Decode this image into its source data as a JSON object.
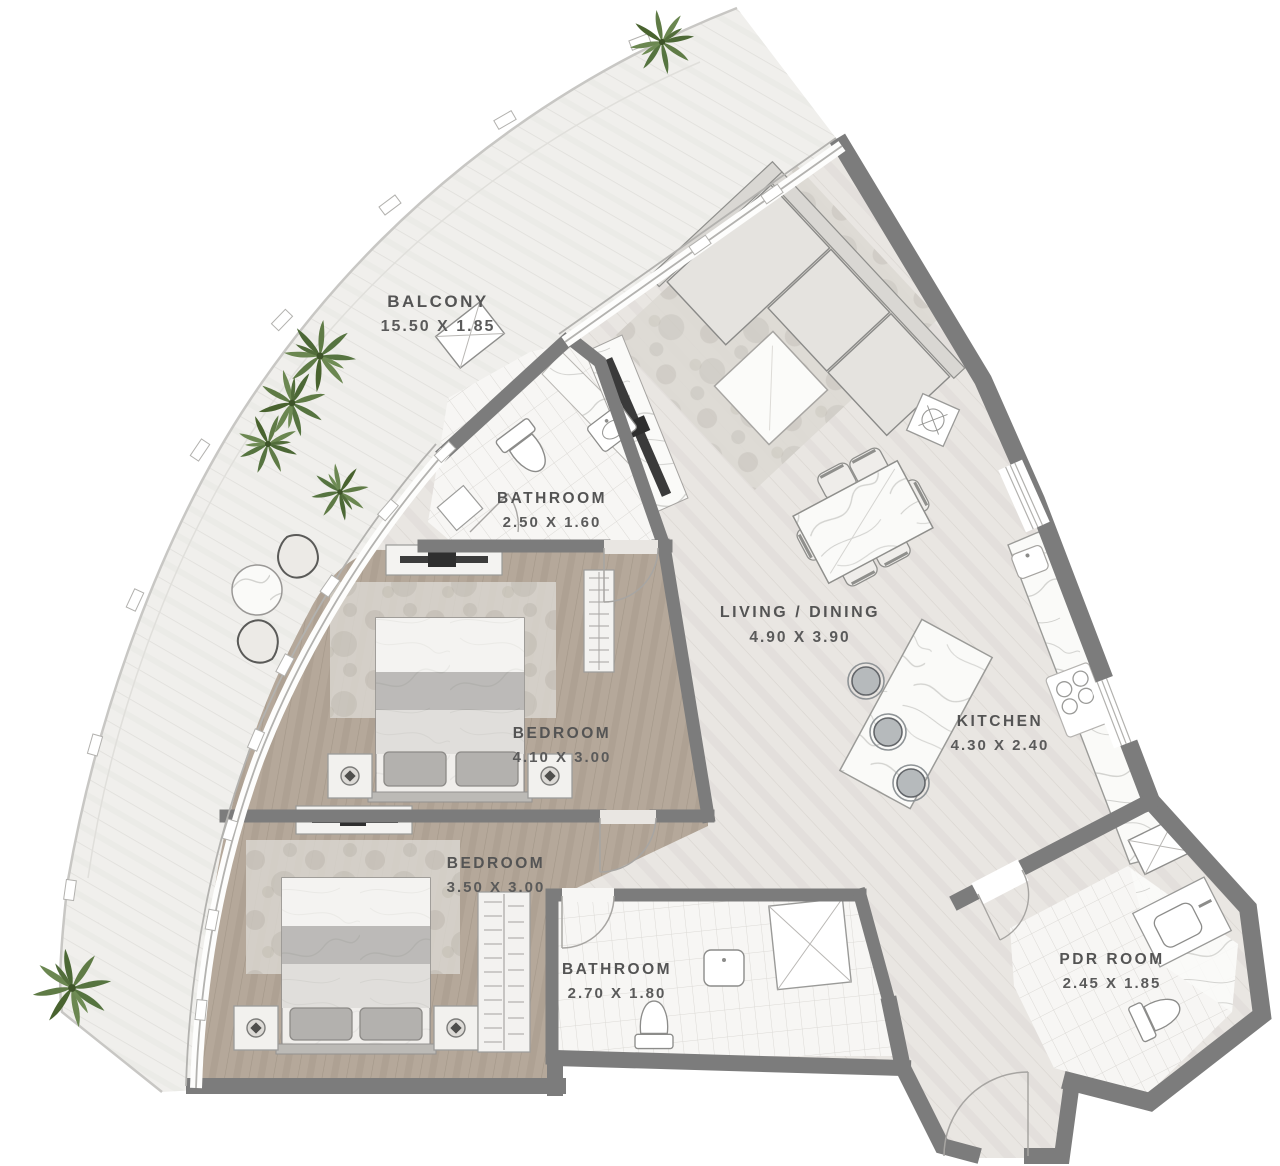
{
  "plan": {
    "type": "apartment-floorplan",
    "rooms": [
      {
        "id": "balcony",
        "name": "BALCONY",
        "dims": "15.50 X 1.85"
      },
      {
        "id": "bathroom-1",
        "name": "BATHROOM",
        "dims": "2.50 X 1.60"
      },
      {
        "id": "bedroom-1",
        "name": "BEDROOM",
        "dims": "4.10 X 3.00"
      },
      {
        "id": "bedroom-2",
        "name": "BEDROOM",
        "dims": "3.50 X 3.00"
      },
      {
        "id": "bathroom-2",
        "name": "BATHROOM",
        "dims": "2.70 X 1.80"
      },
      {
        "id": "living-dining",
        "name": "LIVING / DINING",
        "dims": "4.90 X 3.90"
      },
      {
        "id": "kitchen",
        "name": "KITCHEN",
        "dims": "4.30 X 2.40"
      },
      {
        "id": "pdr-room",
        "name": "PDR ROOM",
        "dims": "2.45 X 1.85"
      }
    ],
    "colors": {
      "wall": "#7c7c7c",
      "balcony_floor": "#f0efec",
      "living_floor": "#e9e6e2",
      "bedroom_floor": "#b5a89a",
      "tile_floor": "#f7f6f4",
      "label_text": "#545454",
      "plant_green": "#5d7a46",
      "tv_black": "#3a3a3a",
      "stool_gray": "#b6babc"
    }
  }
}
